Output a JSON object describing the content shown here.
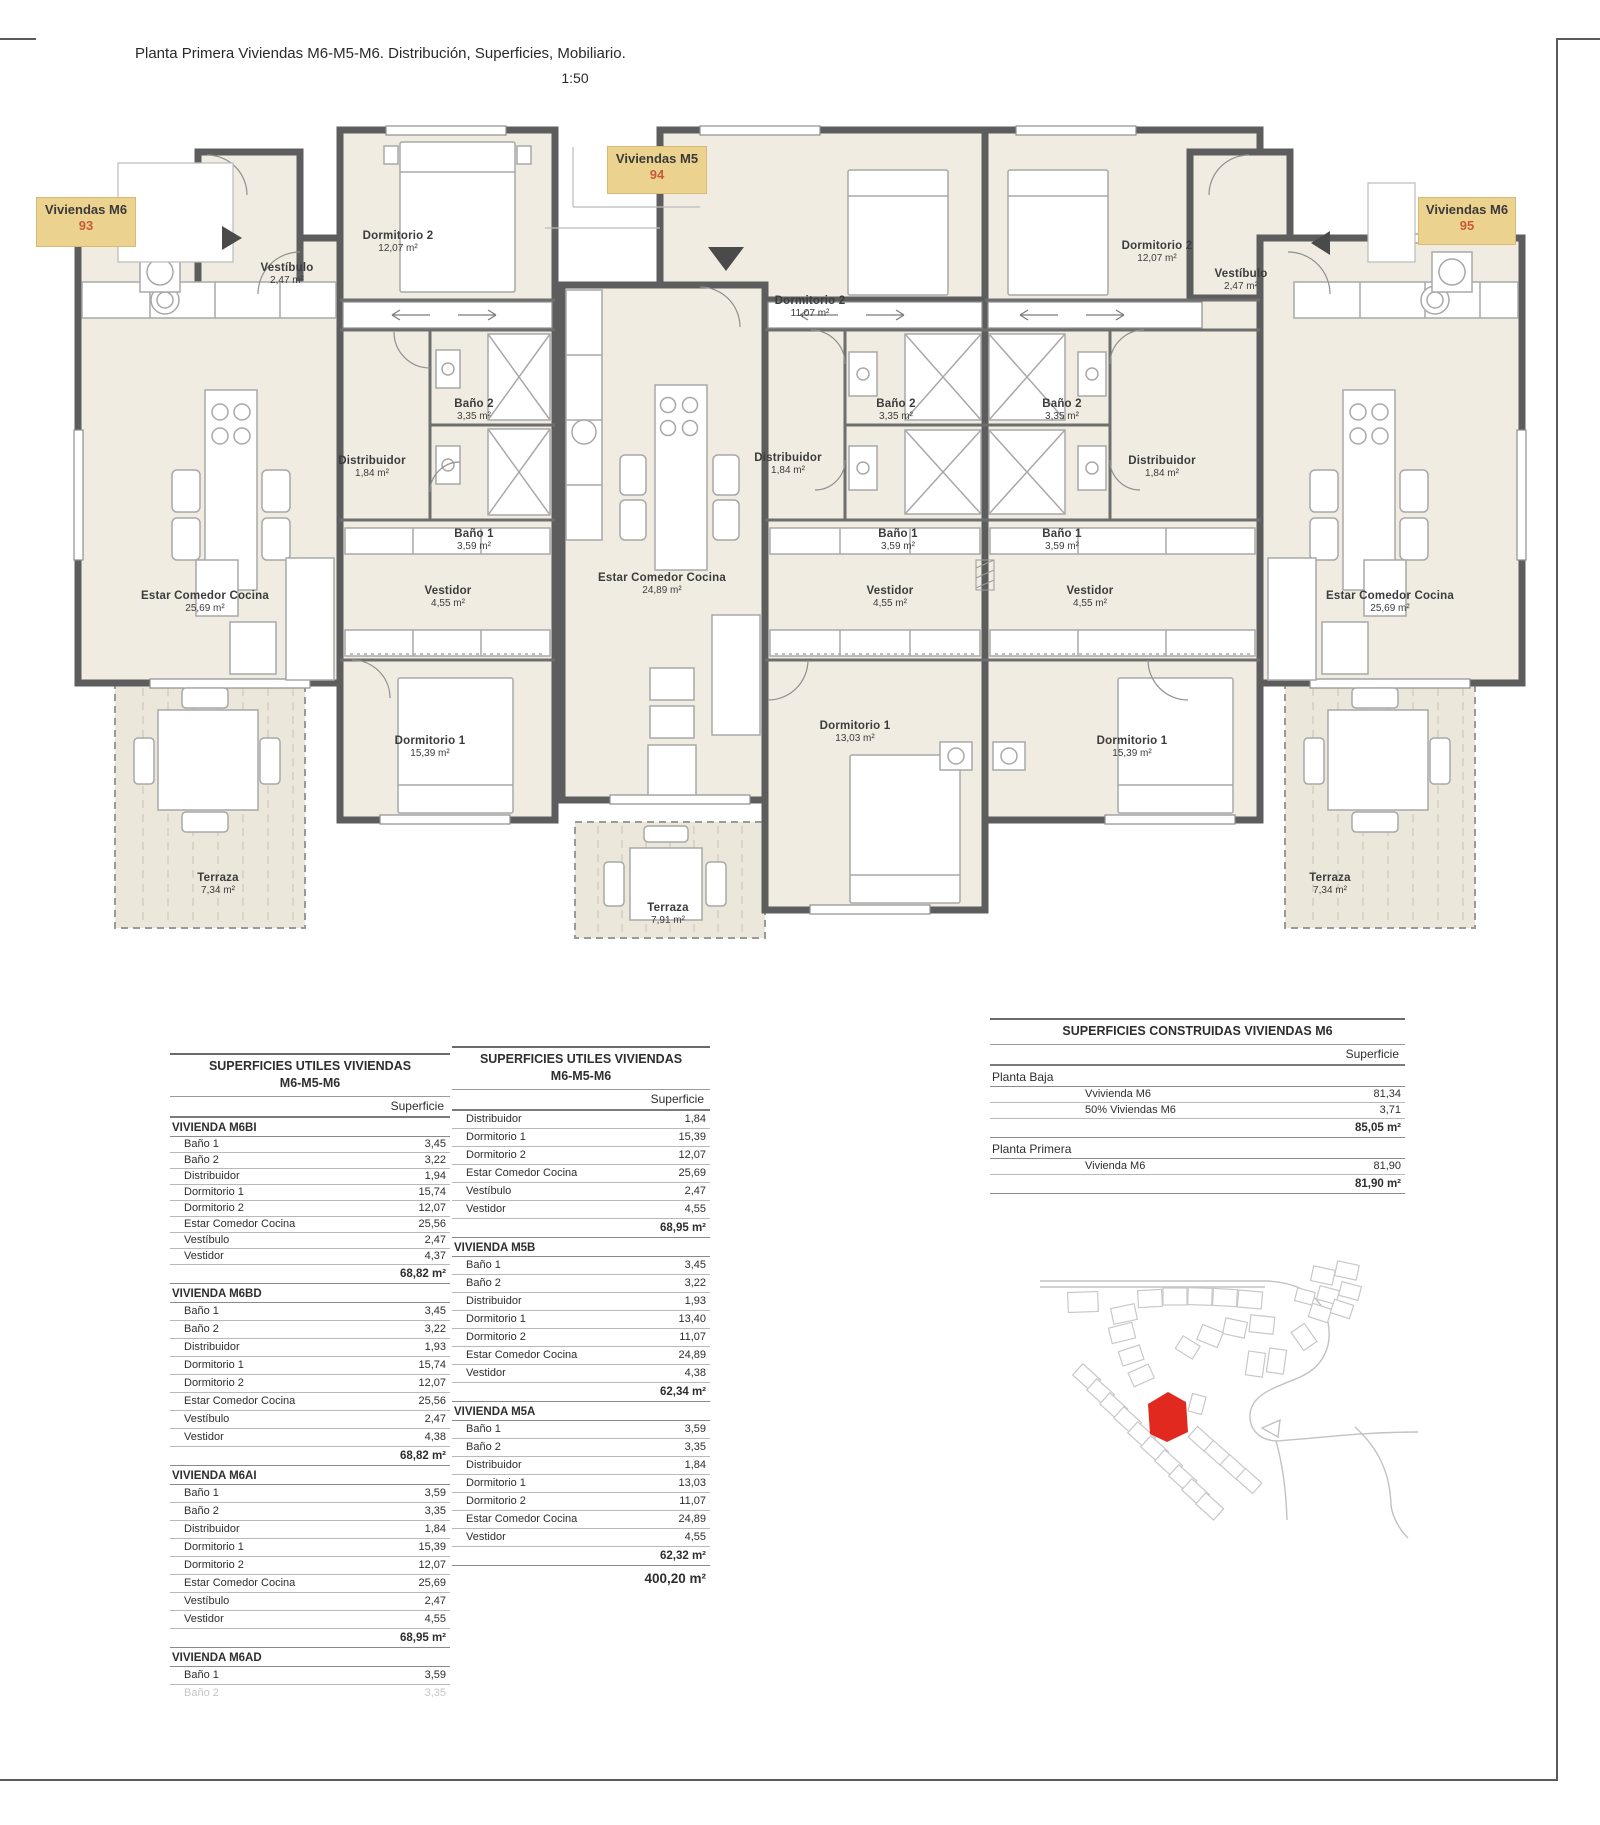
{
  "sheet": {
    "title": "Planta Primera Viviendas M6-M5-M6. Distribución, Superficies, Mobiliario.",
    "scale": "1:50"
  },
  "colors": {
    "badge_bg": "#ecd28f",
    "badge_number": "#c75b39",
    "wall": "#5d5d5d",
    "floor": "#f0ece2",
    "terrace": "#ece7db",
    "site_marker": "#e2291f"
  },
  "badges": [
    {
      "label": "Viviendas M6",
      "number": "93",
      "arrow": "right"
    },
    {
      "label": "Viviendas M5",
      "number": "94",
      "arrow": "down"
    },
    {
      "label": "Viviendas M6",
      "number": "95",
      "arrow": "left"
    }
  ],
  "rooms": [
    {
      "unit": "93",
      "name": "Vestíbulo",
      "area": "2,47 m²",
      "x": 287,
      "y": 262
    },
    {
      "unit": "93",
      "name": "Dormitorio 2",
      "area": "12,07 m²",
      "x": 398,
      "y": 230
    },
    {
      "unit": "93",
      "name": "Baño 2",
      "area": "3,35 m²",
      "x": 474,
      "y": 398
    },
    {
      "unit": "93",
      "name": "Distribuidor",
      "area": "1,84 m²",
      "x": 372,
      "y": 455
    },
    {
      "unit": "93",
      "name": "Baño 1",
      "area": "3,59 m²",
      "x": 474,
      "y": 528
    },
    {
      "unit": "93",
      "name": "Estar Comedor Cocina",
      "area": "25,69 m²",
      "x": 205,
      "y": 590
    },
    {
      "unit": "93",
      "name": "Vestidor",
      "area": "4,55 m²",
      "x": 448,
      "y": 585
    },
    {
      "unit": "93",
      "name": "Dormitorio 1",
      "area": "15,39 m²",
      "x": 430,
      "y": 735
    },
    {
      "unit": "93",
      "name": "Terraza",
      "area": "7,34 m²",
      "x": 218,
      "y": 872
    },
    {
      "unit": "94",
      "name": "Dormitorio 2",
      "area": "11,07 m²",
      "x": 810,
      "y": 295
    },
    {
      "unit": "94",
      "name": "Baño 2",
      "area": "3,35 m²",
      "x": 896,
      "y": 398
    },
    {
      "unit": "94",
      "name": "Distribuidor",
      "area": "1,84 m²",
      "x": 788,
      "y": 452
    },
    {
      "unit": "94",
      "name": "Baño 1",
      "area": "3,59 m²",
      "x": 898,
      "y": 528
    },
    {
      "unit": "94",
      "name": "Estar Comedor Cocina",
      "area": "24,89 m²",
      "x": 662,
      "y": 572
    },
    {
      "unit": "94",
      "name": "Vestidor",
      "area": "4,55 m²",
      "x": 890,
      "y": 585
    },
    {
      "unit": "94",
      "name": "Dormitorio 1",
      "area": "13,03 m²",
      "x": 855,
      "y": 720
    },
    {
      "unit": "94",
      "name": "Terraza",
      "area": "7,91 m²",
      "x": 668,
      "y": 902
    },
    {
      "unit": "95",
      "name": "Dormitorio 2",
      "area": "12,07 m²",
      "x": 1157,
      "y": 240
    },
    {
      "unit": "95",
      "name": "Vestíbulo",
      "area": "2,47 m²",
      "x": 1241,
      "y": 268
    },
    {
      "unit": "95",
      "name": "Baño 2",
      "area": "3,35 m²",
      "x": 1062,
      "y": 398
    },
    {
      "unit": "95",
      "name": "Distribuidor",
      "area": "1,84 m²",
      "x": 1162,
      "y": 455
    },
    {
      "unit": "95",
      "name": "Baño 1",
      "area": "3,59 m²",
      "x": 1062,
      "y": 528
    },
    {
      "unit": "95",
      "name": "Vestidor",
      "area": "4,55 m²",
      "x": 1090,
      "y": 585
    },
    {
      "unit": "95",
      "name": "Dormitorio 1",
      "area": "15,39 m²",
      "x": 1132,
      "y": 735
    },
    {
      "unit": "95",
      "name": "Estar Comedor Cocina",
      "area": "25,69 m²",
      "x": 1390,
      "y": 590
    },
    {
      "unit": "95",
      "name": "Terraza",
      "area": "7,34 m²",
      "x": 1330,
      "y": 872
    }
  ],
  "tables": {
    "utiles_left": {
      "title_lines": [
        "SUPERFICIES UTILES VIVIENDAS",
        "M6-M5-M6"
      ],
      "col_header": "Superficie",
      "sections": [
        {
          "name": "VIVIENDA M6BI",
          "compact": true,
          "rows": [
            [
              "Baño 1",
              "3,45"
            ],
            [
              "Baño 2",
              "3,22"
            ],
            [
              "Distribuidor",
              "1,94"
            ],
            [
              "Dormitorio 1",
              "15,74"
            ],
            [
              "Dormitorio 2",
              "12,07"
            ],
            [
              "Estar Comedor Cocina",
              "25,56"
            ],
            [
              "Vestíbulo",
              "2,47"
            ],
            [
              "Vestidor",
              "4,37"
            ]
          ],
          "total": "68,82 m²"
        },
        {
          "name": "VIVIENDA M6BD",
          "rows": [
            [
              "Baño 1",
              "3,45"
            ],
            [
              "Baño 2",
              "3,22"
            ],
            [
              "Distribuidor",
              "1,93"
            ],
            [
              "Dormitorio 1",
              "15,74"
            ],
            [
              "Dormitorio 2",
              "12,07"
            ],
            [
              "Estar Comedor Cocina",
              "25,56"
            ],
            [
              "Vestíbulo",
              "2,47"
            ],
            [
              "Vestidor",
              "4,38"
            ]
          ],
          "total": "68,82 m²"
        },
        {
          "name": "VIVIENDA M6AI",
          "rows": [
            [
              "Baño 1",
              "3,59"
            ],
            [
              "Baño 2",
              "3,35"
            ],
            [
              "Distribuidor",
              "1,84"
            ],
            [
              "Dormitorio 1",
              "15,39"
            ],
            [
              "Dormitorio 2",
              "12,07"
            ],
            [
              "Estar Comedor Cocina",
              "25,69"
            ],
            [
              "Vestíbulo",
              "2,47"
            ],
            [
              "Vestidor",
              "4,55"
            ]
          ],
          "total": "68,95 m²"
        },
        {
          "name": "VIVIENDA M6AD",
          "rows": [
            [
              "Baño 1",
              "3,59"
            ]
          ],
          "partial": [
            "Baño 2",
            "3,35"
          ]
        }
      ]
    },
    "utiles_middle": {
      "title_lines": [
        "SUPERFICIES UTILES VIVIENDAS",
        "M6-M5-M6"
      ],
      "col_header": "Superficie",
      "sections": [
        {
          "name": null,
          "rows": [
            [
              "Distribuidor",
              "1,84"
            ],
            [
              "Dormitorio 1",
              "15,39"
            ],
            [
              "Dormitorio 2",
              "12,07"
            ],
            [
              "Estar Comedor Cocina",
              "25,69"
            ],
            [
              "Vestíbulo",
              "2,47"
            ],
            [
              "Vestidor",
              "4,55"
            ]
          ],
          "total": "68,95 m²"
        },
        {
          "name": "VIVIENDA M5B",
          "rows": [
            [
              "Baño 1",
              "3,45"
            ],
            [
              "Baño 2",
              "3,22"
            ],
            [
              "Distribuidor",
              "1,93"
            ],
            [
              "Dormitorio 1",
              "13,40"
            ],
            [
              "Dormitorio 2",
              "11,07"
            ],
            [
              "Estar Comedor Cocina",
              "24,89"
            ],
            [
              "Vestidor",
              "4,38"
            ]
          ],
          "total": "62,34 m²"
        },
        {
          "name": "VIVIENDA M5A",
          "rows": [
            [
              "Baño 1",
              "3,59"
            ],
            [
              "Baño 2",
              "3,35"
            ],
            [
              "Distribuidor",
              "1,84"
            ],
            [
              "Dormitorio 1",
              "13,03"
            ],
            [
              "Dormitorio 2",
              "11,07"
            ],
            [
              "Estar Comedor Cocina",
              "24,89"
            ],
            [
              "Vestidor",
              "4,55"
            ]
          ],
          "total": "62,32 m²"
        }
      ],
      "grand_total": "400,20 m²"
    },
    "construidas": {
      "title_lines": [
        "SUPERFICIES CONSTRUIDAS VIVIENDAS M6"
      ],
      "col_header": "Superficie",
      "sections": [
        {
          "name": "Planta Baja",
          "rows": [
            [
              "Vvivienda M6",
              "81,34"
            ],
            [
              "50% Viviendas M6",
              "3,71"
            ]
          ],
          "total": "85,05 m²"
        },
        {
          "name": "Planta Primera",
          "rows": [
            [
              "Vivienda M6",
              "81,90"
            ]
          ],
          "total": "81,90 m²"
        }
      ]
    }
  }
}
